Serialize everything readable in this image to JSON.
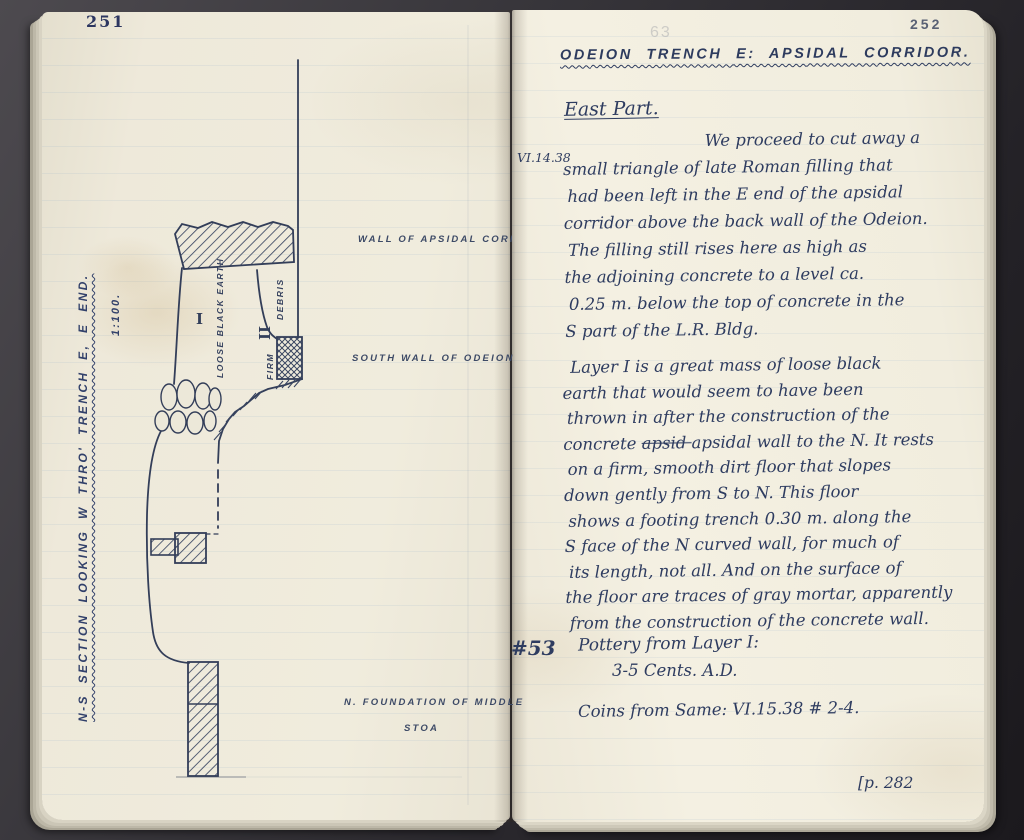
{
  "left_page": {
    "page_number": "251",
    "section_caption": "N-S SECTION LOOKING W THRO' TRENCH E, E END.",
    "scale_label": "1:100.",
    "diagram_labels": {
      "wall_of_apsidal_corridor": "WALL OF APSIDAL CORRIDOR",
      "south_wall_of_odeion": "SOUTH WALL OF ODEION",
      "foundation_line1": "N. FOUNDATION OF MIDDLE",
      "foundation_line2": "STOA",
      "layer_i": "I",
      "layer_i_fill": "LOOSE BLACK EARTH",
      "layer_ii": "II",
      "layer_ii_fill_firm": "FIRM",
      "layer_ii_fill_debris": "DEBRIS"
    }
  },
  "right_page": {
    "page_number": "252",
    "faint_stamp": "63",
    "title": "ODEION TRENCH E: APSIDAL CORRIDOR.",
    "subtitle": "East Part.",
    "margin_date": "VI.14.38",
    "paragraph1_lines": [
      "We proceed to cut away a",
      "small triangle of late Roman filling that",
      "had been left in the E end of the apsidal",
      "corridor above the back wall of the Odeion.",
      "The filling still rises here as high as",
      "the adjoining concrete to a level ca.",
      "0.25 m. below the top of concrete in the",
      "S part of the L.R. Bldg."
    ],
    "paragraph2_lines": [
      "Layer I is a great mass of loose black",
      "earth that would seem to have been",
      "thrown in after the construction of the",
      "concrete ~~apsid~~ apsidal wall to the N. It rests",
      "on a firm, smooth dirt floor that slopes",
      "down gently from S to N. This floor",
      "shows a footing trench 0.30 m. along the",
      "S face of the N curved wall, for much of",
      "its length, not all. And on the surface of",
      "the floor are traces of gray mortar, apparently",
      "from the construction of the concrete wall."
    ],
    "find_number": "#53",
    "find_line1": "Pottery from Layer I:",
    "find_line2": "3-5 Cents. A.D.",
    "coins_line": "Coins from Same: VI.15.38 # 2-4.",
    "footer_note": "[p. 282"
  },
  "colors": {
    "ink": "#2d3b5e",
    "diagram_ink": "#333e59",
    "page_left": "#ece8d9",
    "page_right": "#f1eee2",
    "cover_fabric": "#2a282c"
  }
}
